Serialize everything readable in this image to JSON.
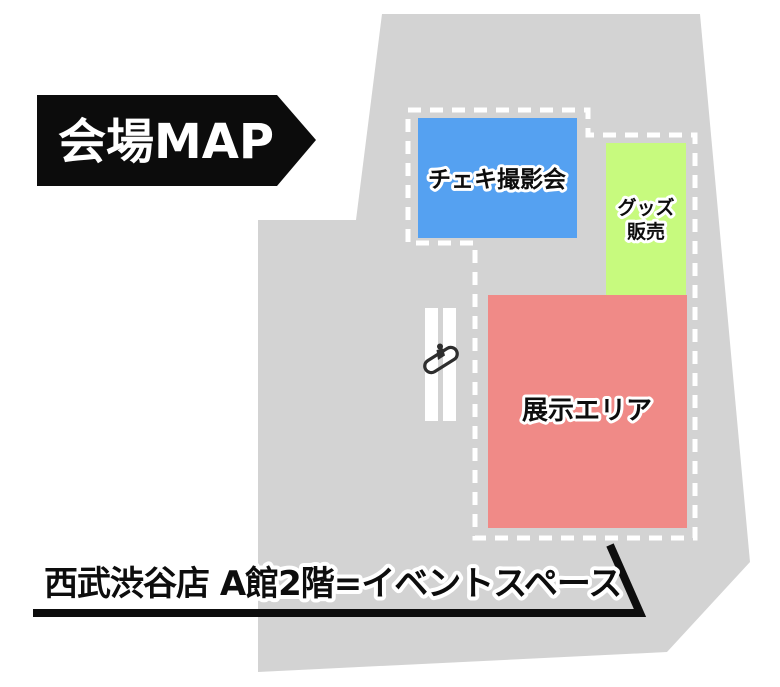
{
  "title_banner": {
    "label": "会場MAP",
    "background_color": "#0c0c0c",
    "text_color": "#ffffff"
  },
  "venue": {
    "floor_color": "#d3d3d3",
    "boundary_color": "#ffffff",
    "areas": [
      {
        "id": "cheki-photo-area",
        "label": "チェキ撮影会",
        "color": "#55a1f1"
      },
      {
        "id": "goods-area",
        "label": "グッズ販売",
        "label_line1": "グッズ",
        "label_line2": "販売",
        "color": "#c7fa7e"
      },
      {
        "id": "exhibition-area",
        "label": "展示エリア",
        "color": "#f08a87"
      }
    ],
    "icons": [
      {
        "name": "escalator-icon",
        "color": "#2e2e2e"
      }
    ]
  },
  "footer": {
    "location_label": "西武渋谷店 A館2階=イベントスペース",
    "underline_color": "#0d0d0d"
  }
}
